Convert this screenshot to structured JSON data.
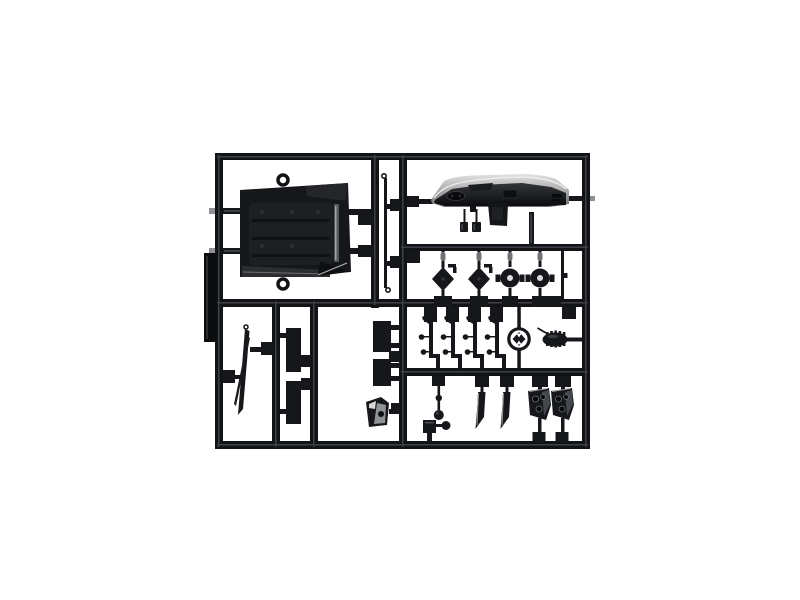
{
  "scene": {
    "type": "product-photo",
    "subject": "Black injection-molded model-kit sprue (parts tree) with scale truck parts, photographed on a white studio background",
    "background": "#ffffff"
  },
  "colors": {
    "plastic": "#15171a",
    "frame": "#121316",
    "tag": "#0b0c0d",
    "sheen": "#3d4045",
    "highlight": "#aeb0b3",
    "pill": "#707276",
    "hole_light": "#dcdcdc",
    "deck_light": "#e2e2e2",
    "deck_dark": "#6f7073"
  },
  "parts": [
    {
      "id": "sprue-frame",
      "label": "rectangular runner frame with internal rails"
    },
    {
      "id": "sprue-id-tag",
      "label": "molded identification tag on left edge"
    },
    {
      "id": "cab-floor-panel",
      "label": "large cab floor / engine cover panel with lifting rings"
    },
    {
      "id": "linkage-rod",
      "label": "long thin linkage rod with hooked ends"
    },
    {
      "id": "dashboard",
      "label": "truck dashboard with instrument cluster, center stack and pedals"
    },
    {
      "id": "hub-diamond-1",
      "label": "diamond axle hub with retainer claw"
    },
    {
      "id": "hub-diamond-2",
      "label": "diamond axle hub with retainer claw"
    },
    {
      "id": "hub-drum-1",
      "label": "round brake-drum hub with center bore"
    },
    {
      "id": "hub-drum-2",
      "label": "round brake-drum hub with center bore"
    },
    {
      "id": "short-link-rod",
      "label": "short vertical link rod"
    },
    {
      "id": "suspension-lever-1",
      "label": "suspension lever with ball studs"
    },
    {
      "id": "suspension-lever-2",
      "label": "suspension lever with ball studs"
    },
    {
      "id": "suspension-lever-3",
      "label": "suspension lever with ball studs"
    },
    {
      "id": "suspension-lever-4",
      "label": "suspension lever with ball studs"
    },
    {
      "id": "steering-wheel",
      "label": "steering wheel with spoked hub"
    },
    {
      "id": "finned-compressor",
      "label": "finned compressor / horn body"
    },
    {
      "id": "ball-stud-rod",
      "label": "rod with ball studs"
    },
    {
      "id": "corner-bracket",
      "label": "small bracket with ball stud"
    },
    {
      "id": "stay-blade-1",
      "label": "tapered stay / mud-flap hanger blade"
    },
    {
      "id": "stay-blade-2",
      "label": "tapered stay / mud-flap hanger blade"
    },
    {
      "id": "bracket-plate-1",
      "label": "drilled mounting bracket plate"
    },
    {
      "id": "bracket-plate-2",
      "label": "drilled mounting bracket plate"
    },
    {
      "id": "wiper-blade",
      "label": "long thin wiper / trim blade"
    },
    {
      "id": "flap-rect-1",
      "label": "rectangular mud flap"
    },
    {
      "id": "flap-rect-2",
      "label": "rectangular mud flap"
    },
    {
      "id": "flap-rect-3",
      "label": "rectangular mud flap"
    },
    {
      "id": "flap-rect-4",
      "label": "rectangular mud flap"
    },
    {
      "id": "boot-wedge",
      "label": "wedge-shaped step / boot part"
    }
  ]
}
